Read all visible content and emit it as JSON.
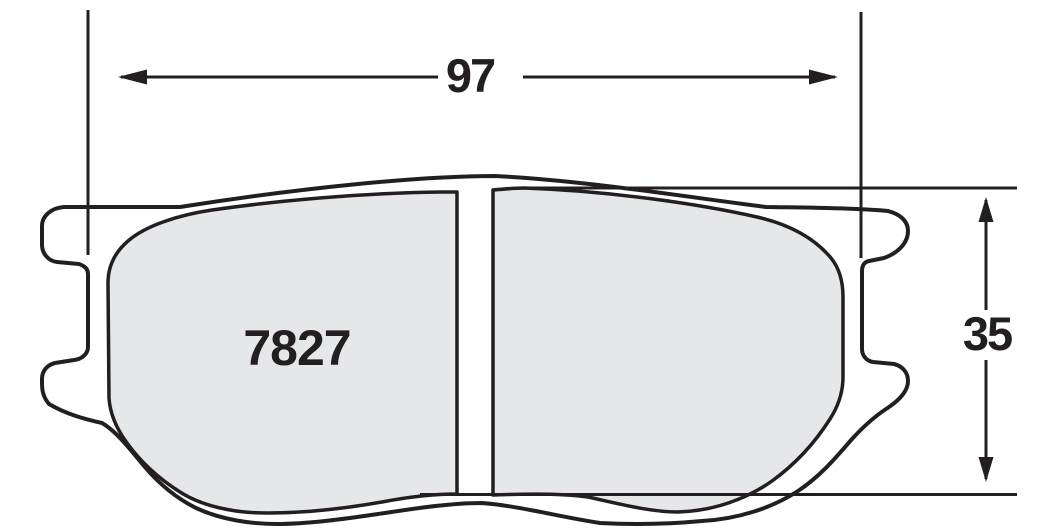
{
  "diagram": {
    "type": "brake-pad-technical-drawing",
    "part_number": "7827",
    "width_dimension": "97",
    "height_dimension": "35",
    "colors": {
      "line": "#231f20",
      "friction_fill": "#e6e7e8",
      "background": "#ffffff"
    }
  }
}
